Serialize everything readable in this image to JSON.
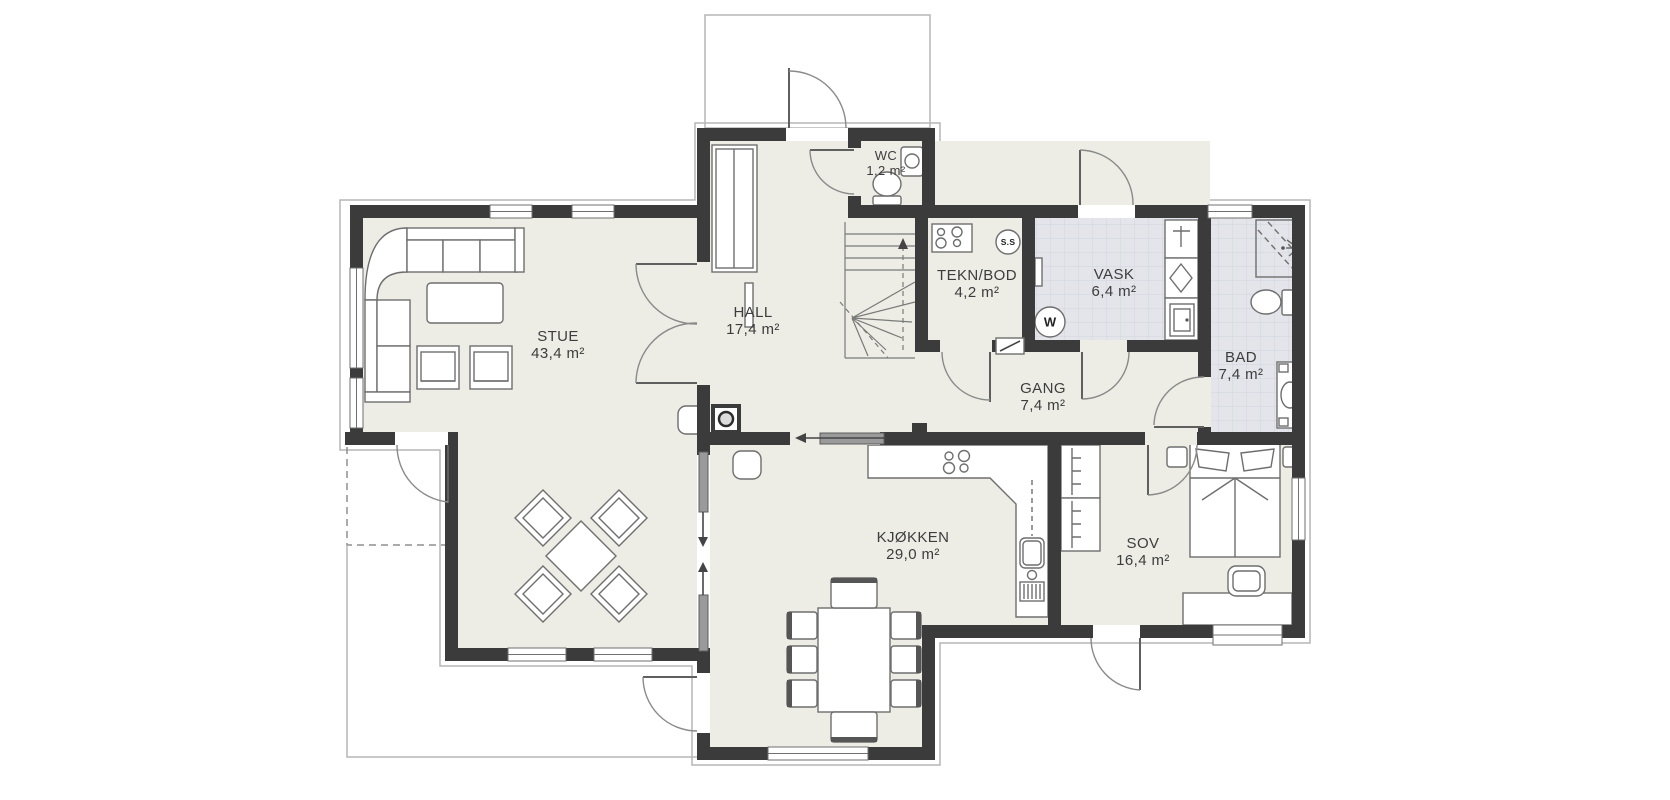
{
  "plan": {
    "type": "floor-plan",
    "rooms": [
      {
        "id": "stue",
        "name": "STUE",
        "area": "43,4 m²"
      },
      {
        "id": "hall",
        "name": "HALL",
        "area": "17,4 m²"
      },
      {
        "id": "wc",
        "name": "WC",
        "area": "1,2 m²"
      },
      {
        "id": "teknbod",
        "name": "TEKN/BOD",
        "area": "4,2 m²"
      },
      {
        "id": "vask",
        "name": "VASK",
        "area": "6,4 m²"
      },
      {
        "id": "bad",
        "name": "BAD",
        "area": "7,4 m²"
      },
      {
        "id": "gang",
        "name": "GANG",
        "area": "7,4 m²"
      },
      {
        "id": "kjokken",
        "name": "KJØKKEN",
        "area": "29,0 m²"
      },
      {
        "id": "sov",
        "name": "SOV",
        "area": "16,4 m²"
      }
    ],
    "markers": {
      "washing_machine": "W",
      "system_unit": "S.S"
    },
    "colors": {
      "wall": "#3b3b3b",
      "floor": "#edece5",
      "wet_room_floor": "#e3e5ea",
      "outline": "#b5b5b5",
      "furniture_line": "#6e6e6e",
      "label": "#3d3d3d"
    }
  }
}
